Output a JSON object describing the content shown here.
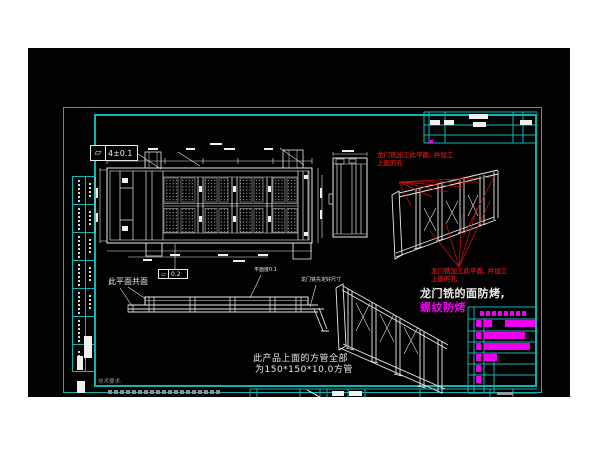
{
  "colors": {
    "background": "#ffffff",
    "cad_background": "#020202",
    "frame_cyan": "#15b2b2",
    "drawing_white": "#e9e9e9",
    "annotation_red": "#c41111",
    "highlight_magenta": "#ee00ee",
    "note_grey": "#8f8f8f"
  },
  "tolerance_boxes": {
    "box1": {
      "symbol": "▱",
      "value": "4±0.1"
    },
    "box2": {
      "symbol": "▱",
      "value": "0.2"
    }
  },
  "notes": {
    "coplanar": "此平面共面",
    "flatness": "平面度0.1",
    "gantry_fit": "龙门铣先定好尺寸",
    "red_machining_line1": "龙门铣加工此平面, 并加工",
    "red_machining_line2": "上面的孔",
    "bake_protect_line1": "龙门铣的面防烤,",
    "bake_protect_line2": "螺纹防烤",
    "tube_spec_line1": "此产品上面的方管全部",
    "tube_spec_line2": "为150*150*10.0方管",
    "tech_req_title": "技术要求:"
  }
}
